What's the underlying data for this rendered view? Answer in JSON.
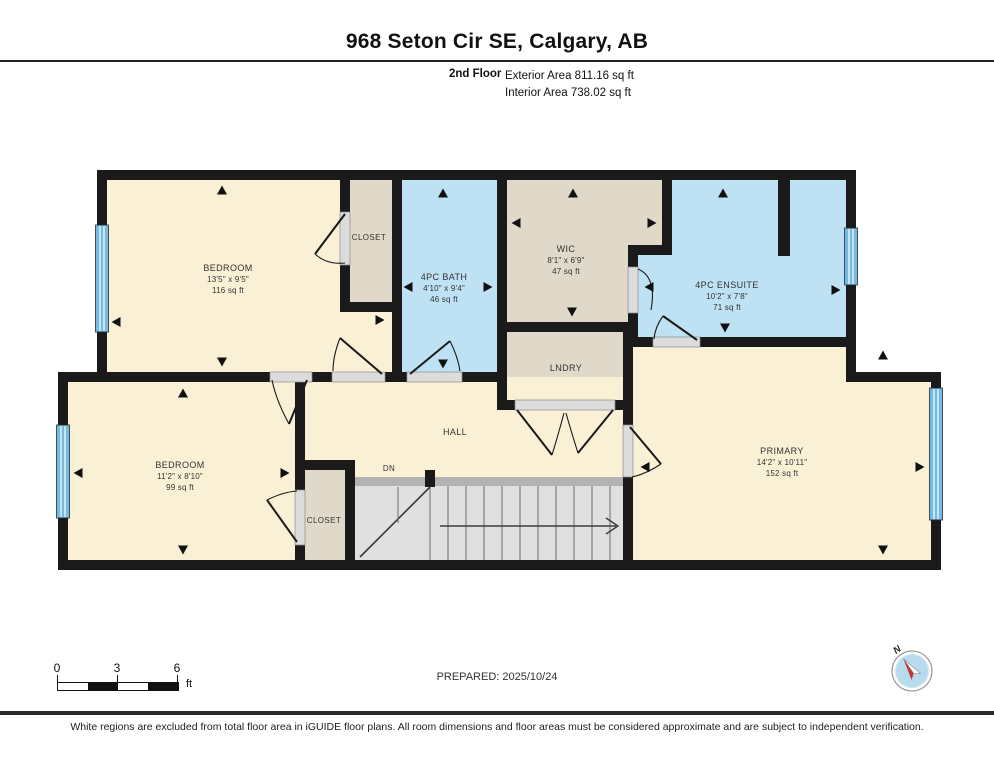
{
  "header": {
    "title": "968 Seton Cir SE, Calgary, AB",
    "floor_label": "2nd Floor",
    "exterior_area": "Exterior Area 811.16 sq ft",
    "interior_area": "Interior Area 738.02 sq ft"
  },
  "rooms": {
    "bedroom1": {
      "name": "BEDROOM",
      "dim": "13'5\" x 9'5\"",
      "area": "116 sq ft"
    },
    "closet1": {
      "name": "CLOSET"
    },
    "bath": {
      "name": "4PC BATH",
      "dim": "4'10\" x 9'4\"",
      "area": "46 sq ft"
    },
    "wic": {
      "name": "WIC",
      "dim": "8'1\" x 6'9\"",
      "area": "47 sq ft"
    },
    "ensuite": {
      "name": "4PC ENSUITE",
      "dim": "10'2\" x 7'8\"",
      "area": "71 sq ft"
    },
    "laundry": {
      "name": "LNDRY"
    },
    "primary": {
      "name": "PRIMARY",
      "dim": "14'2\" x 10'11\"",
      "area": "152 sq ft"
    },
    "bedroom2": {
      "name": "BEDROOM",
      "dim": "11'2\" x 8'10\"",
      "area": "99 sq ft"
    },
    "closet2": {
      "name": "CLOSET"
    },
    "hall": {
      "name": "HALL"
    },
    "stairs": {
      "down_label": "DN"
    }
  },
  "colors": {
    "wall": "#1a1a1a",
    "cream": "#faf0d6",
    "tan": "#e0d8c8",
    "blue": "#bfe1f4",
    "window": "#74bbe2",
    "stairs": "#e0e0e0"
  },
  "footer": {
    "scale": {
      "tick0": "0",
      "tick1": "3",
      "tick2": "6",
      "unit": "ft"
    },
    "prepared": "PREPARED: 2025/10/24",
    "compass_north": "N",
    "disclaimer": "White regions are excluded from total floor area in iGUIDE floor plans. All room dimensions and floor areas must be considered approximate and are subject to independent verification."
  }
}
